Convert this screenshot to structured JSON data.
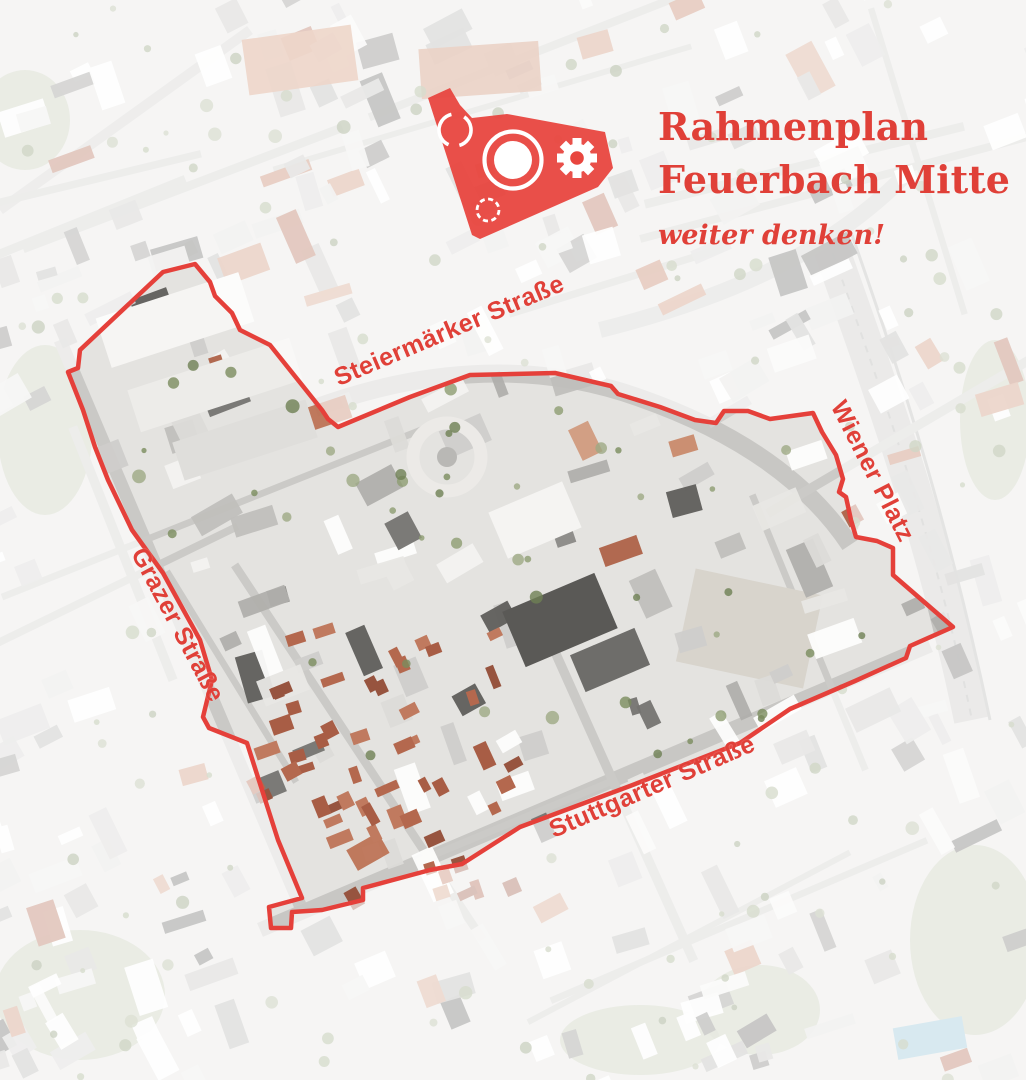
{
  "header": {
    "title_line1": "Rahmenplan",
    "title_line2": "Feuerbach Mitte",
    "subtitle": "weiter denken!"
  },
  "map": {
    "street_labels": [
      {
        "id": "steiermaerker-strasse",
        "label": "Steiermärker Straße"
      },
      {
        "id": "wiener-platz",
        "label": "Wiener Platz"
      },
      {
        "id": "grazer-strasse",
        "label": "Grazer Straße"
      },
      {
        "id": "stuttgarter-strasse",
        "label": "Stuttgarter Straße"
      }
    ],
    "boundary_points": "195,264 163,272 80,350 78,368 68,372 83,410 95,447 108,480 132,530 163,573 200,640 212,680 203,717 209,728 247,743 262,790 278,840 302,898 269,907 271,928 291,928 292,912 322,910 363,900 363,888 430,870 462,864 520,827 630,786 740,743 790,709 855,681 906,658 910,646 953,627 893,575 893,548 877,541 856,537 851,520 846,497 839,492 843,479 836,455 822,432 813,413 770,419 748,411 724,411 716,423 695,420 660,407 618,394 611,386 555,373 470,375 410,397 338,427 328,419 322,410 270,345 240,330 232,313 215,296 210,282"
  },
  "colors": {
    "accent_red": "#e04038",
    "boundary_red": "#e5403a",
    "logo_red": "#e8463f",
    "fade_white": "#ffffff"
  }
}
